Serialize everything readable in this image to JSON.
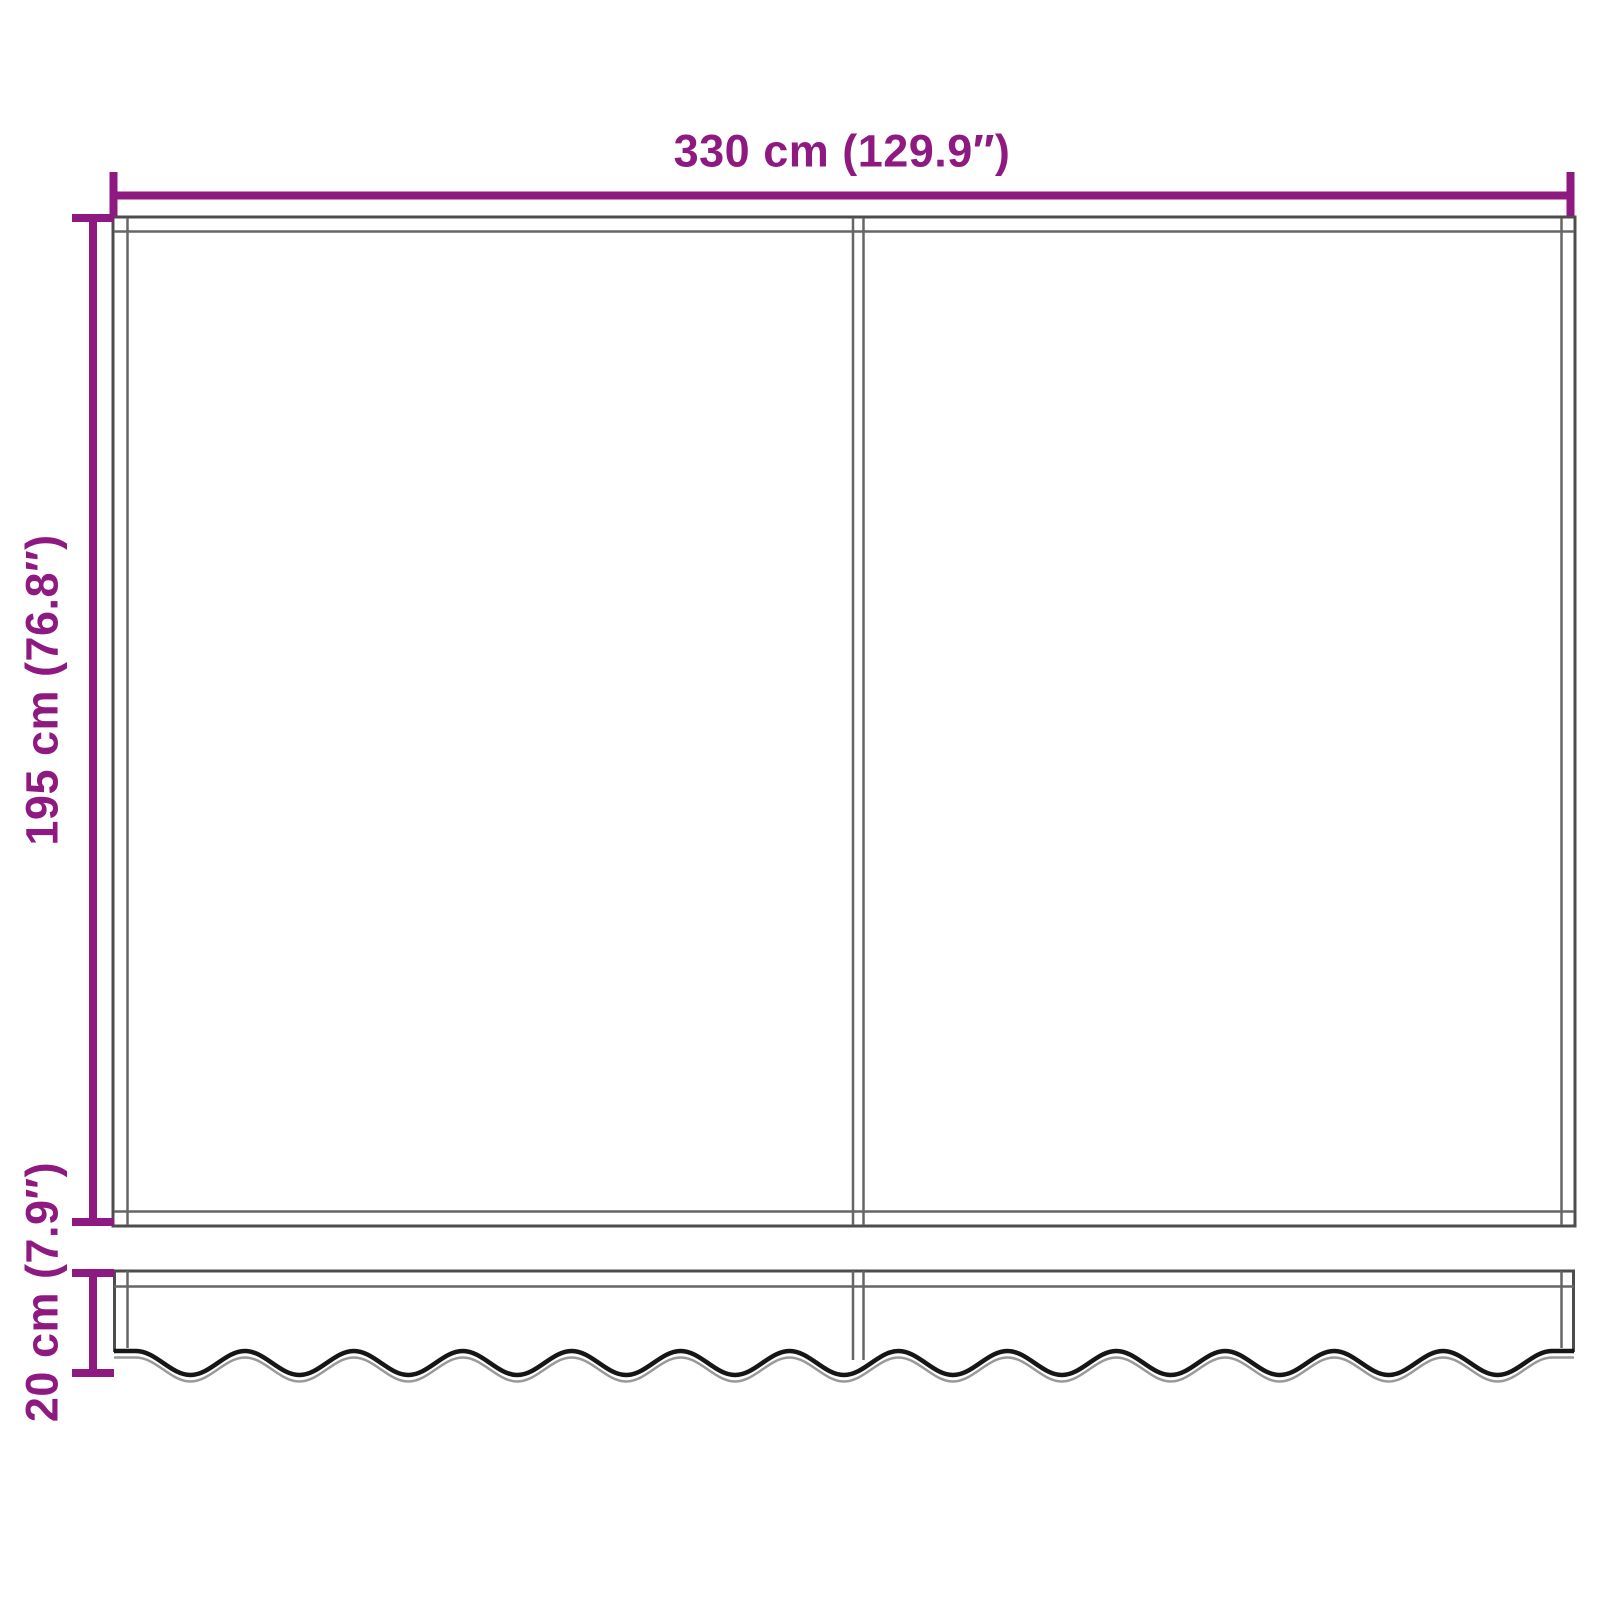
{
  "diagram": {
    "width_dimension": {
      "label": "330 cm (129.9″)"
    },
    "height_dimension": {
      "label": "195 cm (76.8″)"
    },
    "valance_dimension": {
      "label": "20 cm (7.9″)"
    }
  },
  "colors": {
    "dimension_accent": "#8E1980",
    "outline": "#4D4D4D",
    "inner_line": "#666666",
    "wave_primary": "#161616",
    "wave_secondary": "#999999",
    "background": "#FFFFFF"
  }
}
